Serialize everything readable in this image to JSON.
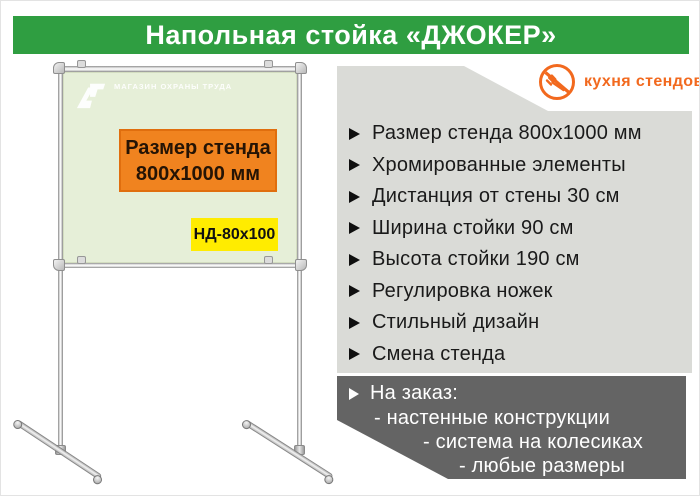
{
  "header": {
    "title": "Напольная стойка «ДЖОКЕР»",
    "bg_color": "#2f9e41"
  },
  "brand": {
    "name": "кухня стендов",
    "color": "#f2691e",
    "icon": "no-fork-icon"
  },
  "stand": {
    "watermark_text": "МАГАЗИН ОХРАНЫ ТРУДА",
    "board_color": "#e6efd8",
    "size_label": {
      "line1": "Размер стенда",
      "line2": "800x1000  мм",
      "bg_color": "#f0831f"
    },
    "model_label": {
      "text": "НД-80x100",
      "bg_color": "#ffec00"
    }
  },
  "features": {
    "bg_color": "#dadbd7",
    "items": [
      "Размер стенда 800х1000 мм",
      "Хромированные элементы",
      "Дистанция от стены 30 см",
      "Ширина стойки 90 см",
      "Высота стойки 190 см",
      "Регулировка ножек",
      "Стильный дизайн",
      "Смена стенда"
    ]
  },
  "custom_order": {
    "bg_color": "#646464",
    "title": "На заказ:",
    "lines": [
      "- настенные конструкции",
      "- система на колесиках",
      "- любые размеры"
    ]
  }
}
